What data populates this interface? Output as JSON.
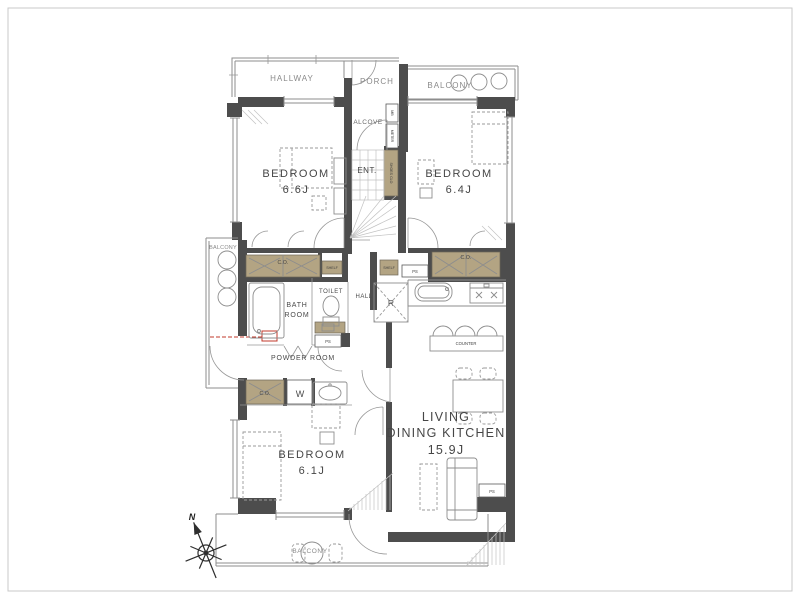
{
  "title": "apartment-floor-plan",
  "colors": {
    "wall": "#4d4d4d",
    "closet": "#b3a483",
    "line": "#8d8d8d",
    "accent_red": "#c0392b",
    "text": "#464646",
    "background": "#ffffff"
  },
  "rooms": {
    "hallway": {
      "label": "HALLWAY"
    },
    "porch": {
      "label": "PORCH"
    },
    "balcony_top": {
      "label": "BALCONY"
    },
    "balcony_left": {
      "label": "BALCONY"
    },
    "balcony_bottom": {
      "label": "BALCONY"
    },
    "alcove": {
      "label": "ALCOVE"
    },
    "entrance": {
      "label": "ENT."
    },
    "bedroom_a": {
      "label": "BEDROOM",
      "size": "6.6J"
    },
    "bedroom_b": {
      "label": "BEDROOM",
      "size": "6.4J"
    },
    "bedroom_c": {
      "label": "BEDROOM",
      "size": "6.1J"
    },
    "bath": {
      "label_line1": "BATH",
      "label_line2": "ROOM"
    },
    "toilet": {
      "label": "TOILET"
    },
    "hall": {
      "label": "HALL"
    },
    "powder_room": {
      "label": "POWDER ROOM"
    },
    "ldk": {
      "label_line1": "LIVING",
      "label_line2": "DINING KITCHEN",
      "size": "15.9J"
    }
  },
  "fixtures": {
    "closet_left": "C.O.",
    "closet_right": "C.O.",
    "closet_bedroom_c": "C.O.",
    "shelf_left": "SHELF",
    "shelf_right": "SHELF",
    "shoes_closet": "SHOES CLO",
    "meter_box": "MB",
    "meter": "METER",
    "pipe_space_1": "PS",
    "pipe_space_2": "PS",
    "pipe_space_3": "PS",
    "refrigerator": "R",
    "washer": "W",
    "counter": "COUNTER"
  },
  "compass": {
    "north": "N"
  }
}
